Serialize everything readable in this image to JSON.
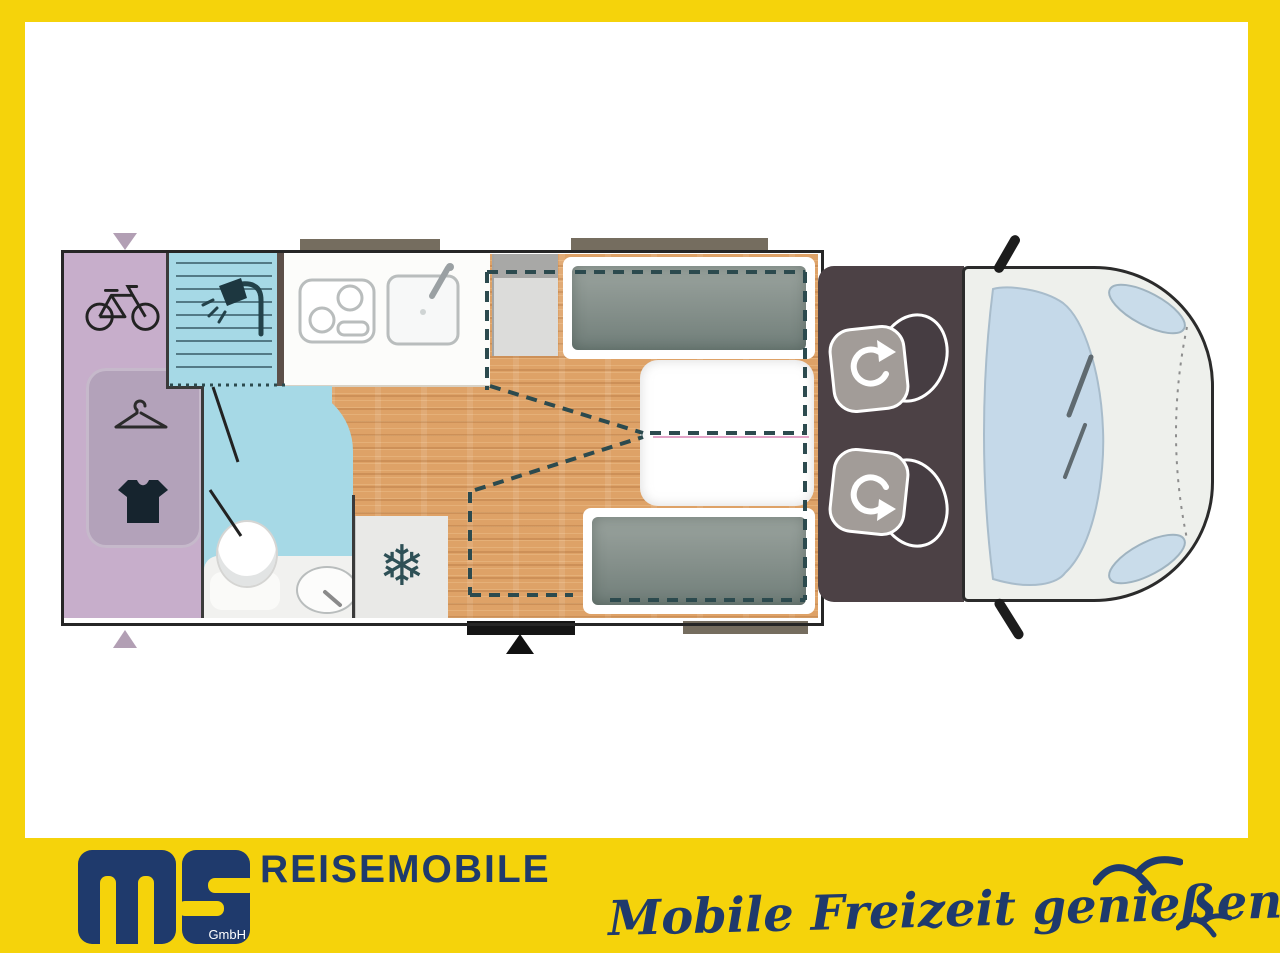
{
  "branding": {
    "logo_text": "ms",
    "logo_subtext": "GmbH",
    "wordmark": "REISEMOBILE",
    "slogan": "Mobile Freizeit genießen."
  },
  "glyphs": {
    "snowflake": "❄"
  },
  "palette": {
    "banner_yellow": "#F5D30B",
    "brand_navy": "#1F3A6C",
    "garage_purple": "#C7AECB",
    "bath_blue": "#A6D9E6",
    "floor_wood": "#DEA267",
    "cab_floor_brown": "#4C4145",
    "bed_grey": "#8A958F",
    "windshield_blue": "#C5D9E9",
    "dashed_teal": "#2C4A4E"
  },
  "floorplan": {
    "type": "motorhome-top-view",
    "zones": [
      {
        "name": "rear-garage",
        "icons": [
          "bicycle-icon",
          "clothes-hanger-icon",
          "shirt-icon"
        ]
      },
      {
        "name": "bathroom",
        "icons": [
          "shower-icon",
          "toilet-icon",
          "washbasin-icon"
        ]
      },
      {
        "name": "kitchen",
        "icons": [
          "hob-icon",
          "sink-icon"
        ]
      },
      {
        "name": "fridge",
        "icons": [
          "snowflake-icon"
        ]
      },
      {
        "name": "bedroom",
        "icons": [
          "single-bed",
          "single-bed",
          "bed-conversion-dashed-outline"
        ]
      },
      {
        "name": "cab",
        "icons": [
          "swivel-seat-rotate-arrow-icon",
          "swivel-seat-rotate-arrow-icon",
          "windscreen",
          "side-mirror",
          "side-mirror"
        ]
      }
    ],
    "markers": [
      "vent-arrow-top",
      "vent-arrow-bottom",
      "entry-step",
      "entry-arrow",
      "window-bars"
    ]
  },
  "decor": {
    "birds": [
      "seagull-large",
      "seagull-small"
    ]
  }
}
